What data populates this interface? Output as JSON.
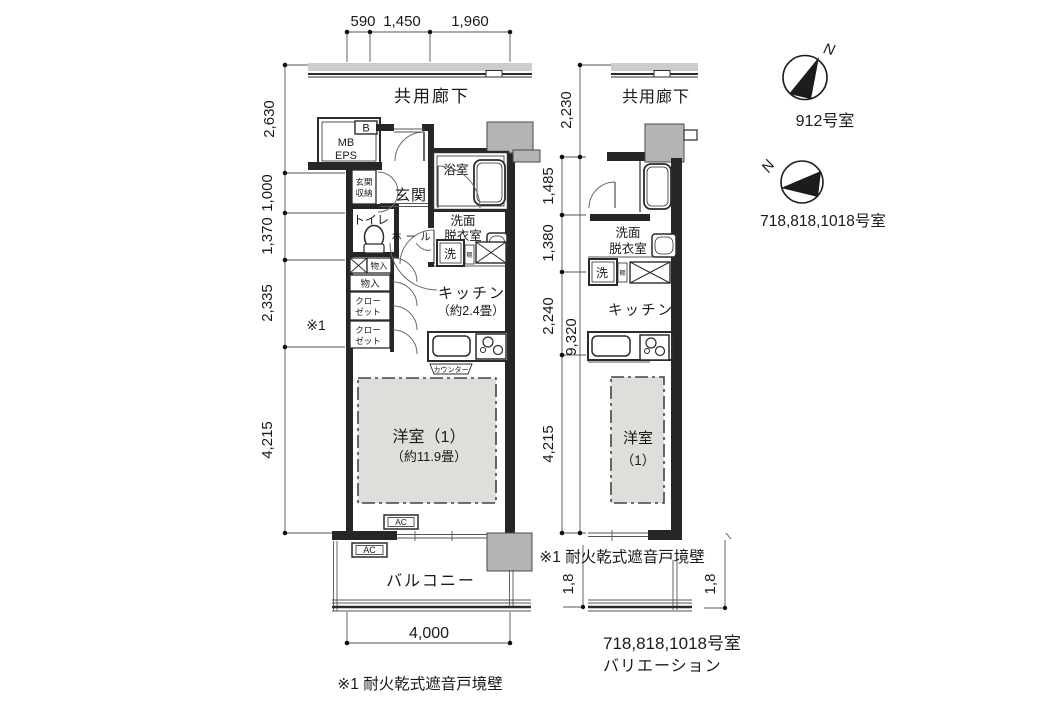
{
  "colors": {
    "ink": "#1f1f1f",
    "wall": "#262626",
    "gray_fill": "#b4b4b4",
    "room_fill": "#dcdfda",
    "paper": "#ffffff"
  },
  "shared": {
    "corridor": "共用廊下",
    "ac": "AC",
    "washer": "洗",
    "shelf": "棚",
    "storage": "物入",
    "closet_l1": "クロー",
    "closet_l2": "ゼット",
    "senmen_l1": "洗面",
    "senmen_l2": "脱衣室",
    "note": "※1 耐火乾式遮音戸境壁",
    "note_ref": "※1"
  },
  "dims": {
    "top": [
      "590",
      "1,450",
      "1,960"
    ],
    "left": [
      "2,630",
      "1,000",
      "1,370",
      "2,335",
      "4,215"
    ],
    "bottom": "4,000",
    "mid": [
      "2,230",
      "1,485",
      "1,380",
      "2,240",
      "4,215"
    ],
    "total": "9,320",
    "balcony_depth": "1,8"
  },
  "left_plan": {
    "b": "B",
    "mb": "MB",
    "eps": "EPS",
    "genkan": "玄関",
    "genkan_shuno_1": "玄関",
    "genkan_shuno_2": "収納",
    "bath": "浴室",
    "toilet": "トイレ",
    "hall": "ホール",
    "kitchen_1": "キッチン",
    "kitchen_2": "（約2.4畳）",
    "counter": "カウンター",
    "west_1": "洋室（1）",
    "west_2": "（約11.9畳）",
    "balcony": "バルコニー"
  },
  "right_plan": {
    "kitchen": "キッチン",
    "west_1": "洋室",
    "west_2": "（1）",
    "caption_1": "718,818,1018号室",
    "caption_2": "バリエーション"
  },
  "compass_912": {
    "n": "N",
    "label": "912号室"
  },
  "compass_718": {
    "n": "N",
    "label": "718,818,1018号室"
  }
}
